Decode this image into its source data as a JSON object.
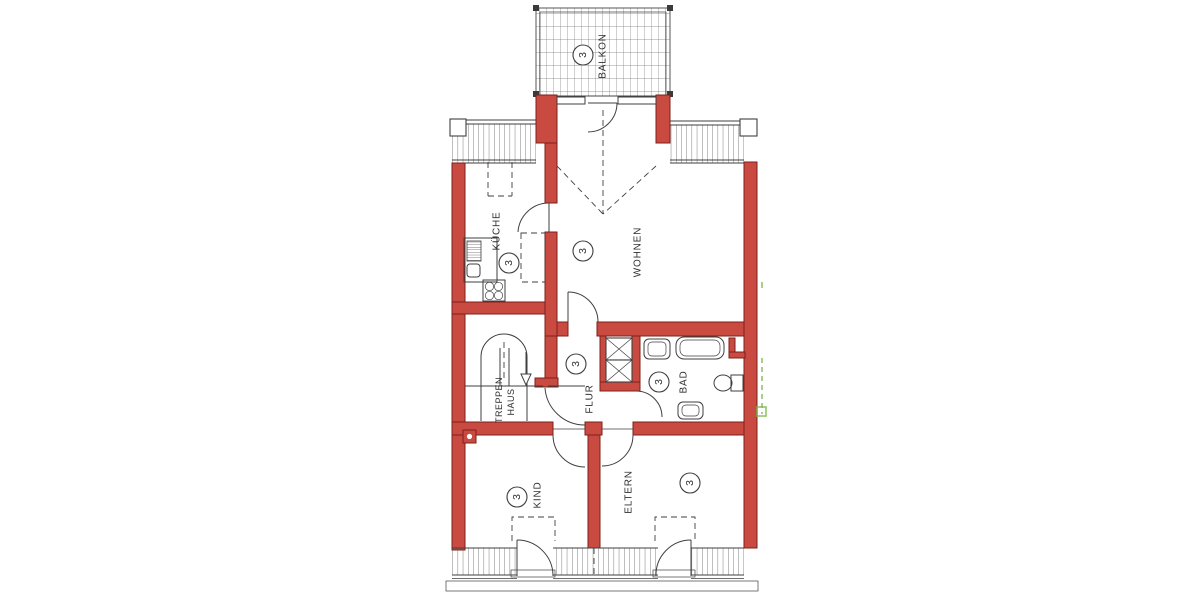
{
  "unit_marker": "3",
  "rooms": {
    "balkon": {
      "label": "BALKON"
    },
    "wohnen": {
      "label": "WOHNEN"
    },
    "kueche": {
      "label": "KÜCHE"
    },
    "flur": {
      "label": "FLUR"
    },
    "treppenhaus": {
      "label_line1": "TREPPEN",
      "label_line2": "HAUS"
    },
    "bad": {
      "label": "BAD"
    },
    "kind": {
      "label": "KIND"
    },
    "eltern": {
      "label": "ELTERN"
    }
  },
  "colors": {
    "wall": "#c94a41",
    "wall_stroke": "#7e201a",
    "line": "#3f3f3f",
    "background": "#ffffff",
    "annotation_green": "#7cb84f"
  }
}
